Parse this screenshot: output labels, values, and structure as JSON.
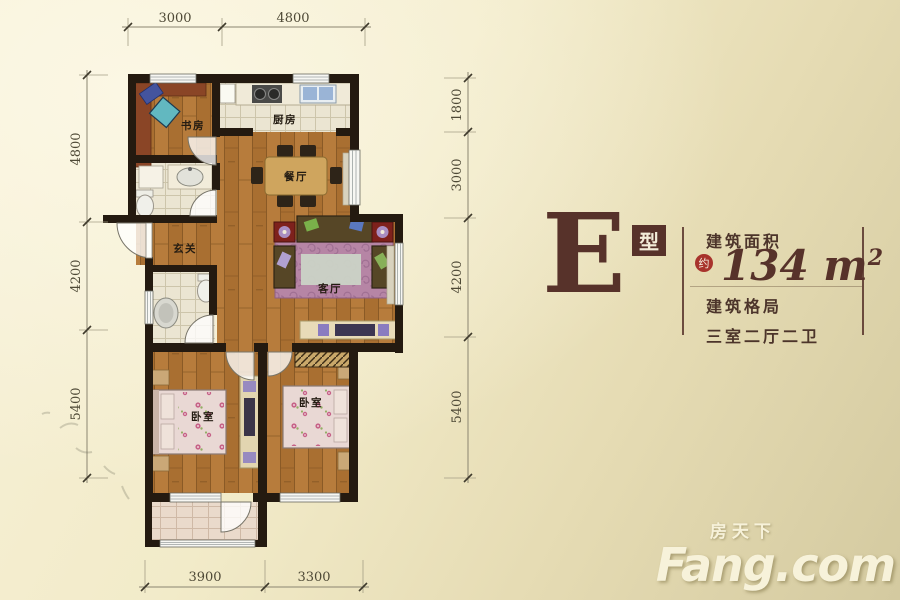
{
  "floor_plan": {
    "rooms": {
      "study": "书房",
      "kitchen": "厨房",
      "dining": "餐厅",
      "entry": "玄关",
      "living": "客厅",
      "bedroom_left": "卧室",
      "bedroom_right": "卧室"
    },
    "dimensions": {
      "top": [
        "3000",
        "4800"
      ],
      "bottom": [
        "3900",
        "3300"
      ],
      "left": [
        "4800",
        "4200",
        "5400"
      ],
      "right": [
        "1800",
        "3000",
        "4200",
        "5400"
      ]
    }
  },
  "panel": {
    "type_letter": "E",
    "type_suffix": "型",
    "area_label": "建筑面积",
    "approx_label": "约",
    "area_value": "134",
    "area_unit": "m",
    "area_exponent": "2",
    "layout_label": "建筑格局",
    "layout_value": "三室二厅二卫"
  },
  "watermark": {
    "cn": "房天下",
    "en": "Fang.com"
  },
  "colors": {
    "accent_maroon": "#57322a",
    "approx_red": "#a8332c",
    "wall": "#241a10",
    "wood": "#a96f31",
    "cream_text": "#f7f2da"
  }
}
